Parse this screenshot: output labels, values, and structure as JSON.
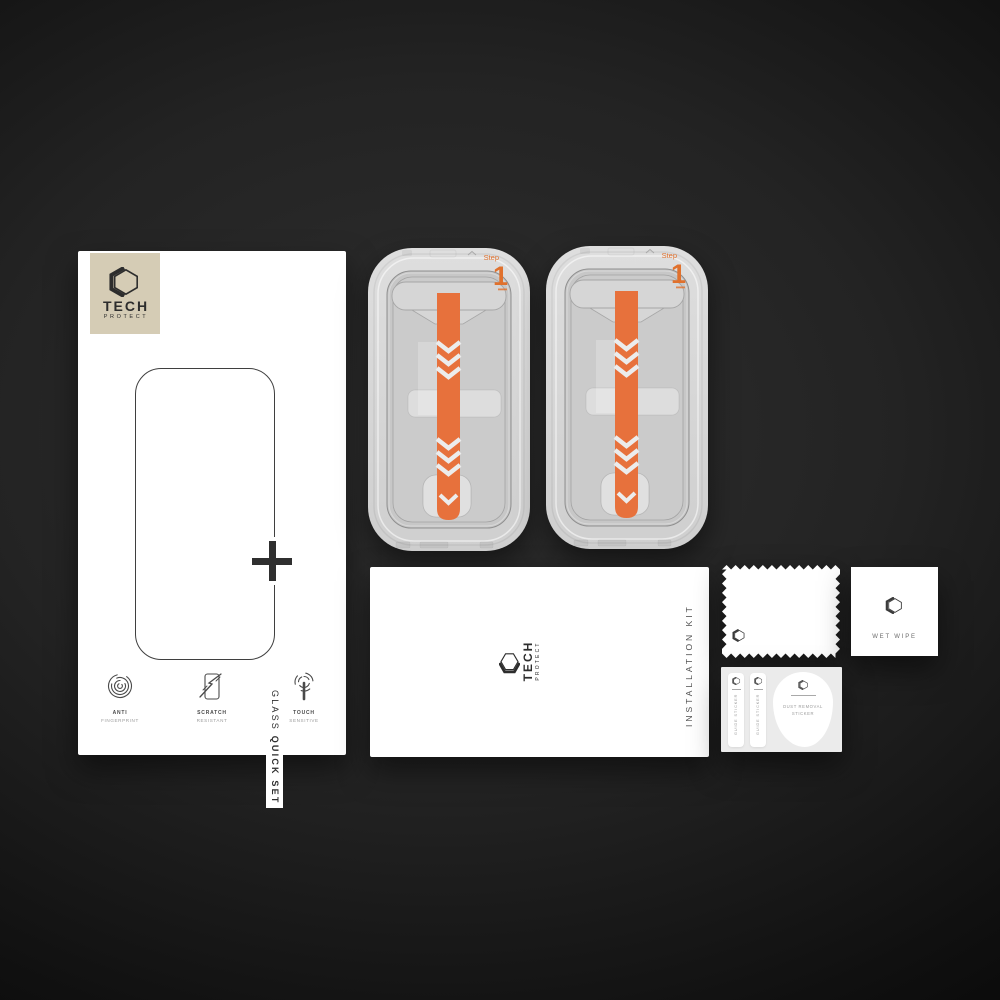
{
  "brand": {
    "name": "TECH",
    "sub": "PROTECT"
  },
  "box": {
    "title": {
      "regular": "GLASS ",
      "bold": "QUICK SET"
    },
    "features": [
      {
        "icon": "fingerprint-icon",
        "line1": "ANTI",
        "line2": "FINGERPRINT"
      },
      {
        "icon": "scratch-icon",
        "line1": "SCRATCH",
        "line2": "RESISTANT"
      },
      {
        "icon": "touch-icon",
        "line1": "TOUCH",
        "line2": "SENSITIVE"
      }
    ]
  },
  "trays": [
    {
      "step_label": "Step",
      "step_number": "1"
    },
    {
      "step_label": "Step",
      "step_number": "1"
    }
  ],
  "envelope": {
    "label": "INSTALLATION KIT"
  },
  "wet_wipe": {
    "label": "WET WIPE"
  },
  "sticker_card": {
    "guide_stickers": [
      {
        "label": "GUIDE STICKER"
      },
      {
        "label": "GUIDE STICKER"
      }
    ],
    "dust_sticker": {
      "line1": "DUST REMOVAL",
      "line2": "STICKER"
    }
  },
  "colors": {
    "accent_orange": "#e7713c",
    "logo_beige": "#d5ccb5",
    "tray_gray": "#d8d8d8"
  }
}
